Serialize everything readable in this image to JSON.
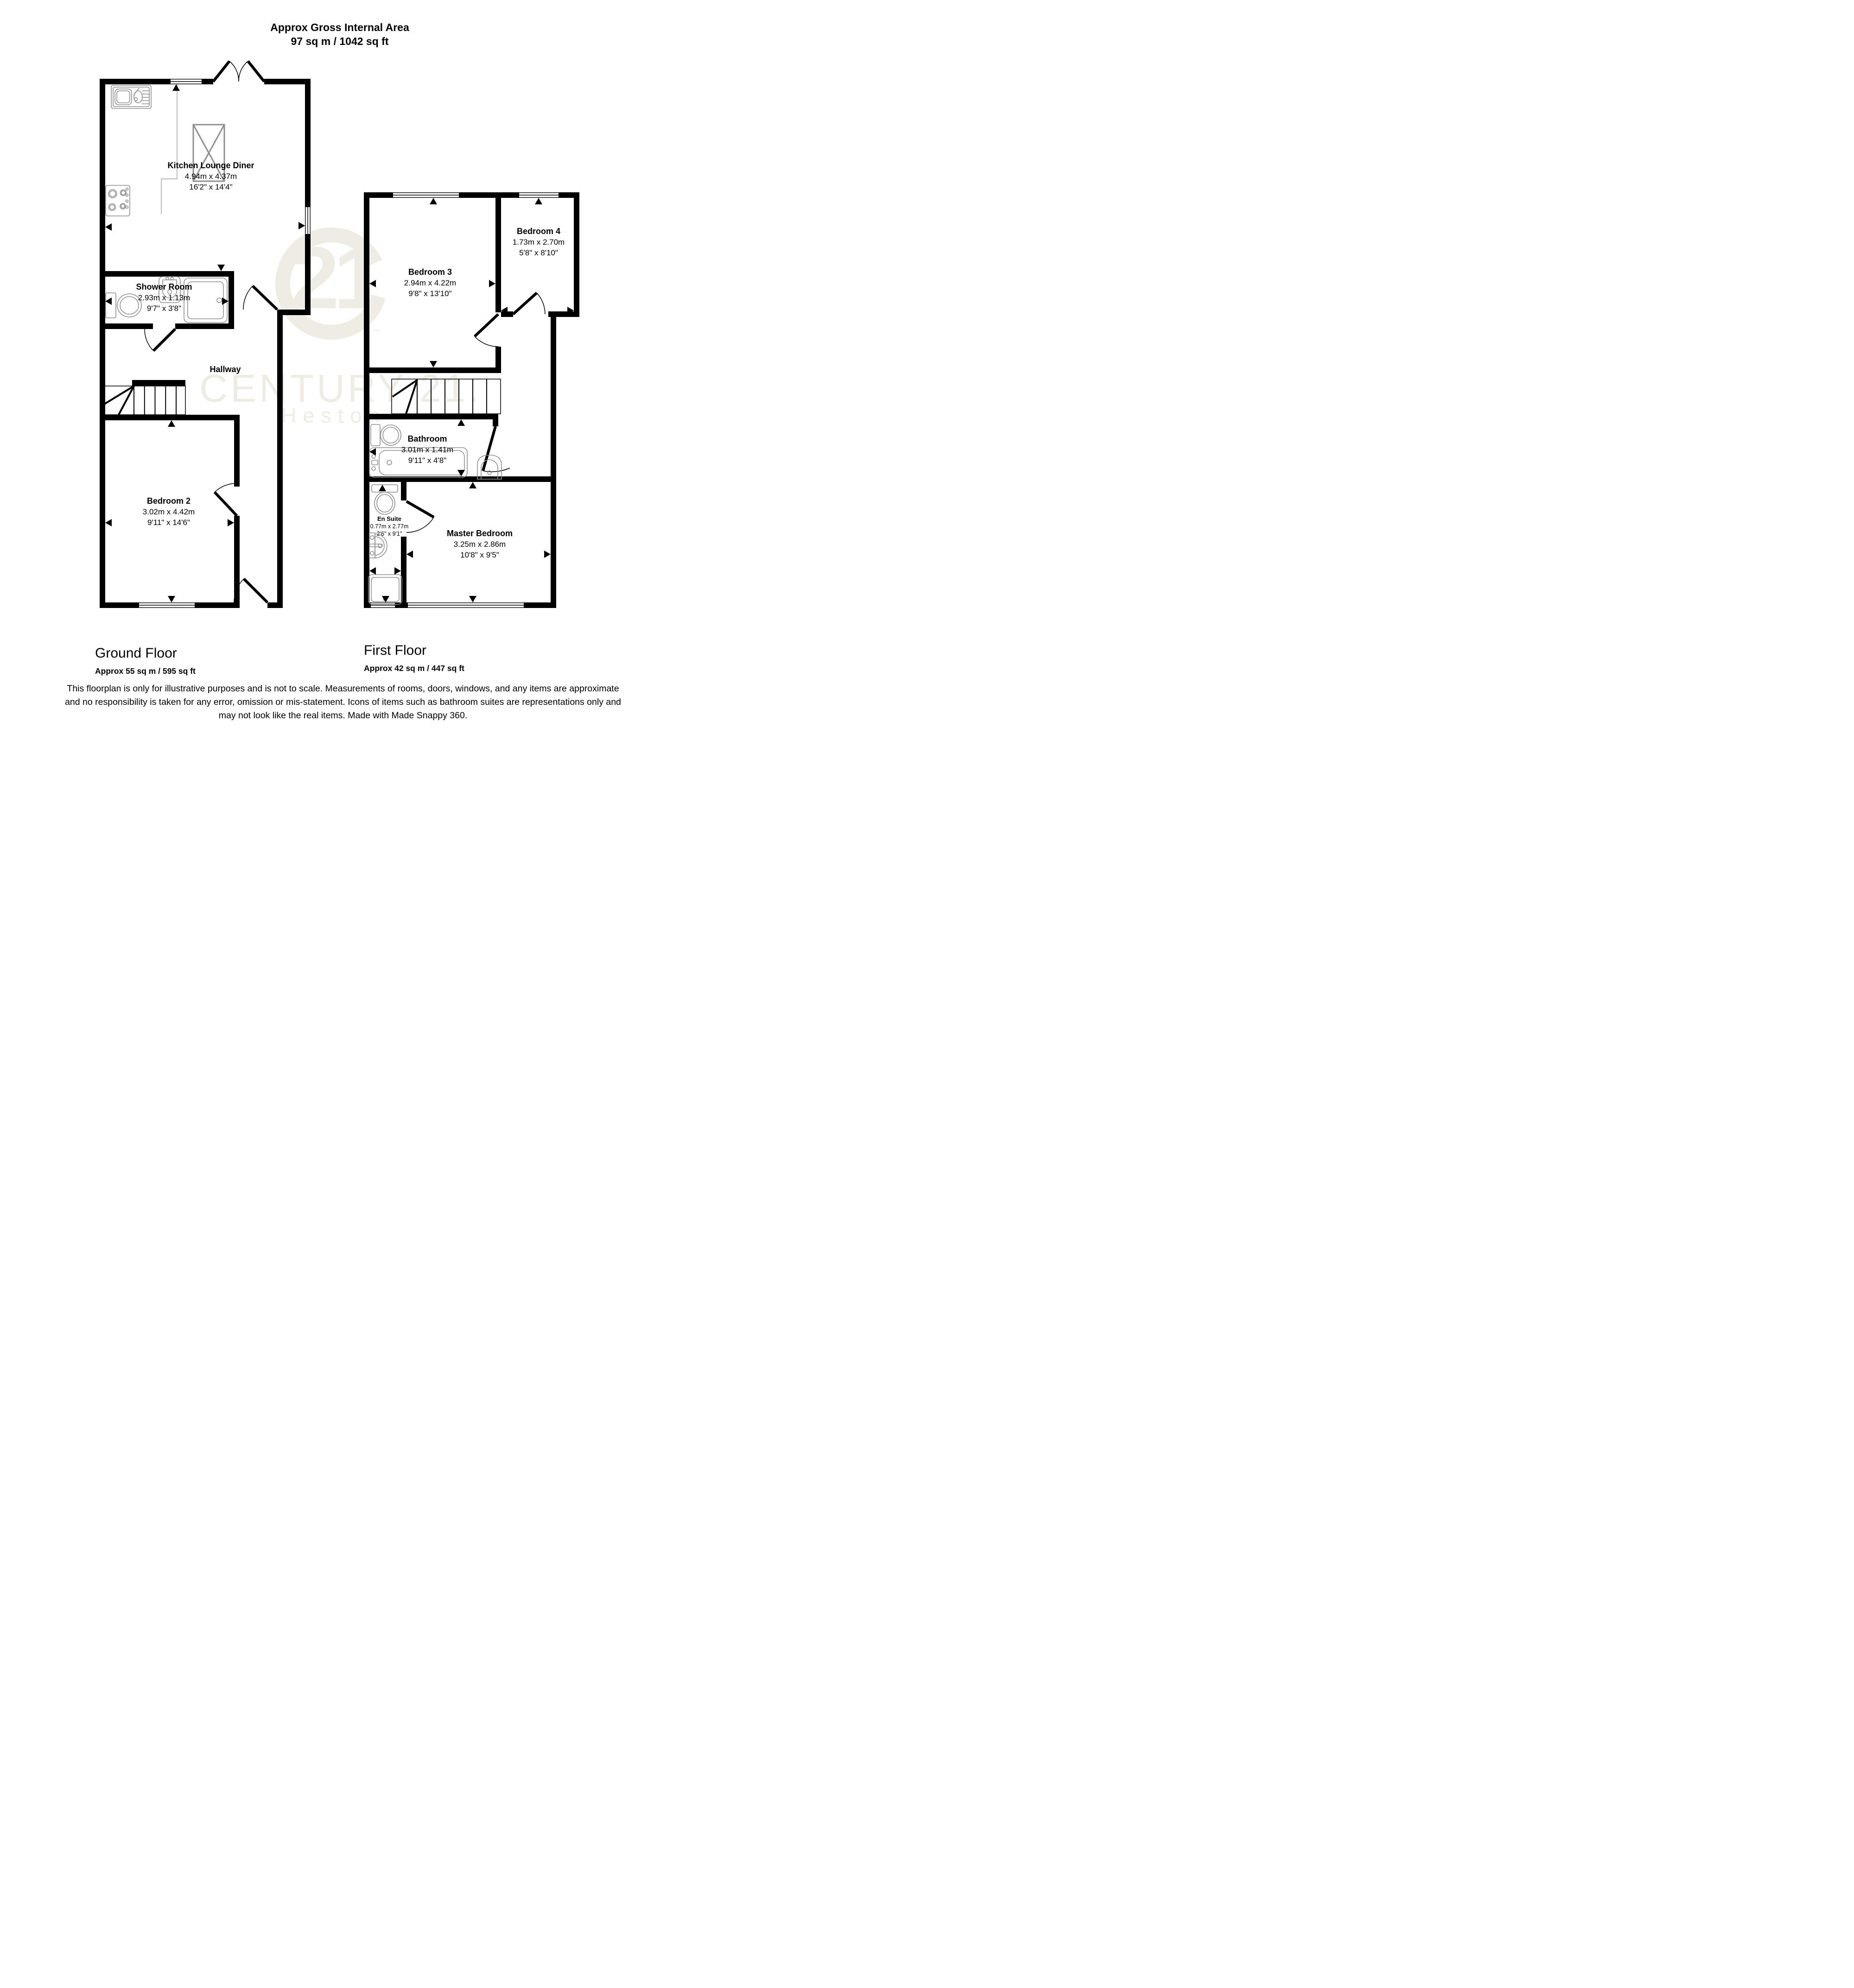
{
  "header": {
    "title": "Approx Gross Internal Area",
    "area": "97 sq m / 1042 sq ft"
  },
  "watermark": {
    "number": "21",
    "tm": "™",
    "brand": "CENTURY 21.",
    "location": "Heston"
  },
  "ground_floor": {
    "title": "Ground Floor",
    "area": "Approx 55 sq m / 595 sq ft",
    "rooms": [
      {
        "name": "Kitchen Lounge Diner",
        "metric": "4.94m x 4.37m",
        "imperial": "16'2\" x 14'4\""
      },
      {
        "name": "Shower Room",
        "metric": "2.93m x 1.13m",
        "imperial": "9'7\" x 3'8\""
      },
      {
        "name": "Hallway",
        "metric": "",
        "imperial": ""
      },
      {
        "name": "Bedroom 2",
        "metric": "3.02m x 4.42m",
        "imperial": "9'11\" x 14'6\""
      }
    ]
  },
  "first_floor": {
    "title": "First Floor",
    "area": "Approx 42 sq m / 447 sq ft",
    "rooms": [
      {
        "name": "Bedroom 3",
        "metric": "2.94m x 4.22m",
        "imperial": "9'8\" x 13'10\""
      },
      {
        "name": "Bedroom 4",
        "metric": "1.73m x 2.70m",
        "imperial": "5'8\" x 8'10\""
      },
      {
        "name": "Bathroom",
        "metric": "3.01m x 1.41m",
        "imperial": "9'11\" x 4'8\""
      },
      {
        "name": "En Suite",
        "metric": "0.77m x 2.77m",
        "imperial": "2'6\" x 9'1\""
      },
      {
        "name": "Master Bedroom",
        "metric": "3.25m x 2.86m",
        "imperial": "10'8\" x 9'5\""
      }
    ]
  },
  "disclaimer": {
    "line1": "This floorplan is only for illustrative purposes and is not to scale. Measurements of rooms, doors, windows, and any items are approximate",
    "line2": "and no responsibility is taken for any error, omission or mis-statement. Icons of items such as bathroom suites are representations only and",
    "line3": "may not look like the real items. Made with Made Snappy 360."
  },
  "colors": {
    "wall": "#000000",
    "fixture": "#8f8f8f",
    "watermark": "#efece3"
  }
}
